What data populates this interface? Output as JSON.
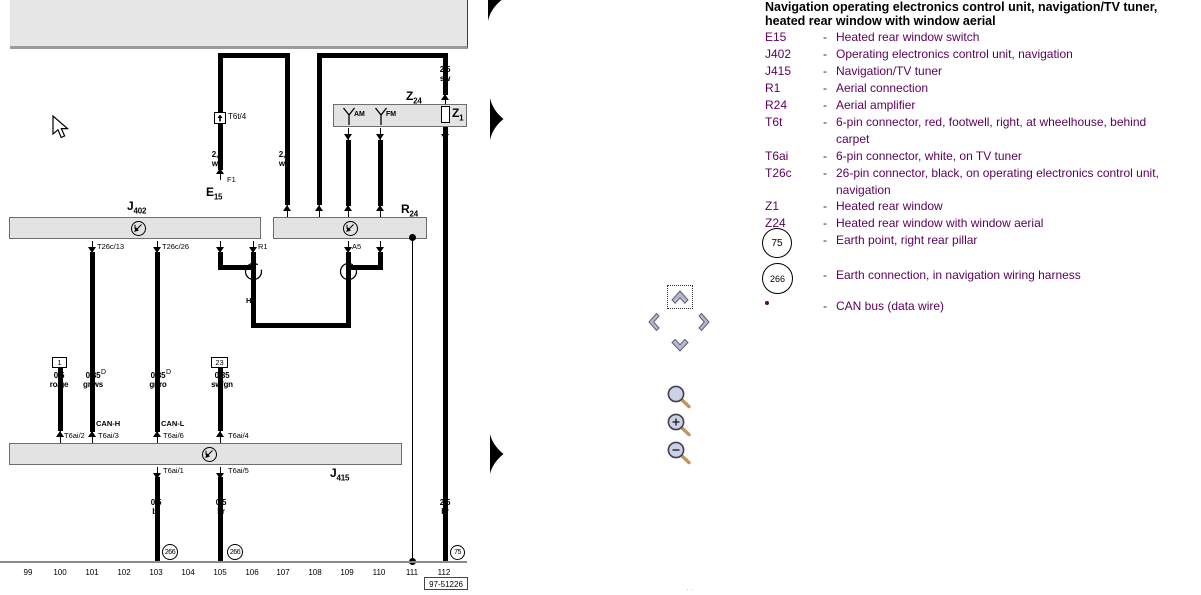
{
  "legend": {
    "title1": "Navigation operating electronics control unit, navigation/TV tuner,",
    "title2": "heated rear window with window aerial",
    "dash": "-",
    "items": [
      {
        "label": "E15",
        "desc": "Heated rear window switch"
      },
      {
        "label": "J402",
        "desc": "Operating electronics control unit, navigation"
      },
      {
        "label": "J415",
        "desc": "Navigation/TV tuner"
      },
      {
        "label": "R1",
        "desc": "Aerial connection"
      },
      {
        "label": "R24",
        "desc": "Aerial amplifier"
      },
      {
        "label": "T6t",
        "desc": "6-pin connector, red, footwell, right, at wheelhouse, behind",
        "desc2": "carpet"
      },
      {
        "label": "T6ai",
        "desc": "6-pin connector, white, on TV tuner"
      },
      {
        "label": "T26c",
        "desc": "26-pin connector, black, on operating electronics control unit,",
        "desc2": "navigation"
      },
      {
        "label": "Z1",
        "desc": "Heated rear window"
      },
      {
        "label": "Z24",
        "desc": "Heated rear window with window aerial"
      }
    ],
    "earth75": {
      "symbol": "75",
      "desc": "Earth point, right rear pillar"
    },
    "earth266": {
      "symbol": "266",
      "desc": "Earth connection, in navigation wiring harness"
    },
    "can_bus": {
      "desc": "CAN bus (data wire)"
    }
  },
  "diagram": {
    "components": {
      "j402": {
        "base": "J",
        "sub": "402"
      },
      "j415": {
        "base": "J",
        "sub": "415"
      },
      "r24": {
        "base": "R",
        "sub": "24"
      },
      "z24": {
        "base": "Z",
        "sub": "24"
      },
      "z1": {
        "base": "Z",
        "sub": "1"
      },
      "e15": {
        "base": "E",
        "sub": "15"
      }
    },
    "pins": {
      "t26c13": "T26c/13",
      "t26c26": "T26c/26",
      "r1": "R1",
      "a5": "A5",
      "t6t4": "T6t/4",
      "f1": "F1",
      "t6ai1": "T6ai/1",
      "t6ai2": "T6ai/2",
      "t6ai3": "T6ai/3",
      "t6ai4": "T6ai/4",
      "t6ai5": "T6ai/5",
      "t6ai6": "T6ai/6"
    },
    "bus": {
      "can_h": "CAN-H",
      "can_l": "CAN-L",
      "hf": "HF"
    },
    "antenna": {
      "am": "AM",
      "fm": "FM"
    },
    "wire_labels": {
      "ws_left": {
        "size": "2,5",
        "color": "ws"
      },
      "ws_right": {
        "size": "2,5",
        "color": "ws"
      },
      "sw_top": {
        "size": "2,5",
        "color": "sw"
      },
      "roge": {
        "size": "0,5",
        "color": "ro/ge"
      },
      "grws": {
        "size": "0,35",
        "color": "gr/ws"
      },
      "grro": {
        "size": "0,35",
        "color": "gr/ro"
      },
      "swgn": {
        "size": "0,35",
        "color": "sw/gn"
      },
      "br1": {
        "size": "0,5",
        "color": "br"
      },
      "br2": {
        "size": "0,5",
        "color": "br"
      },
      "br3": {
        "size": "2,5",
        "color": "br"
      },
      "sup_d": "D"
    },
    "refs": {
      "box1": "1",
      "box23": "23",
      "earth75": "75",
      "earth266": "266"
    },
    "tracks": [
      "99",
      "100",
      "101",
      "102",
      "103",
      "104",
      "105",
      "106",
      "107",
      "108",
      "109",
      "110",
      "111",
      "112"
    ],
    "diagram_number": "97-51226"
  },
  "controls": {
    "pan_up": "pan-up",
    "pan_down": "pan-down",
    "pan_left": "pan-left",
    "pan_right": "pan-right",
    "zoom_tool": "magnifier",
    "zoom_in": "magnifier-plus",
    "zoom_out": "magnifier-minus",
    "page_arrow": "current-track-arrow"
  },
  "colors": {
    "legend_text": "#5c005c",
    "box_fill": "#e3e3e3",
    "chevron_fill": "#b4b8d0",
    "magnifier_glass": "#cdd1e6",
    "magnifier_handle": "#c2945f"
  }
}
